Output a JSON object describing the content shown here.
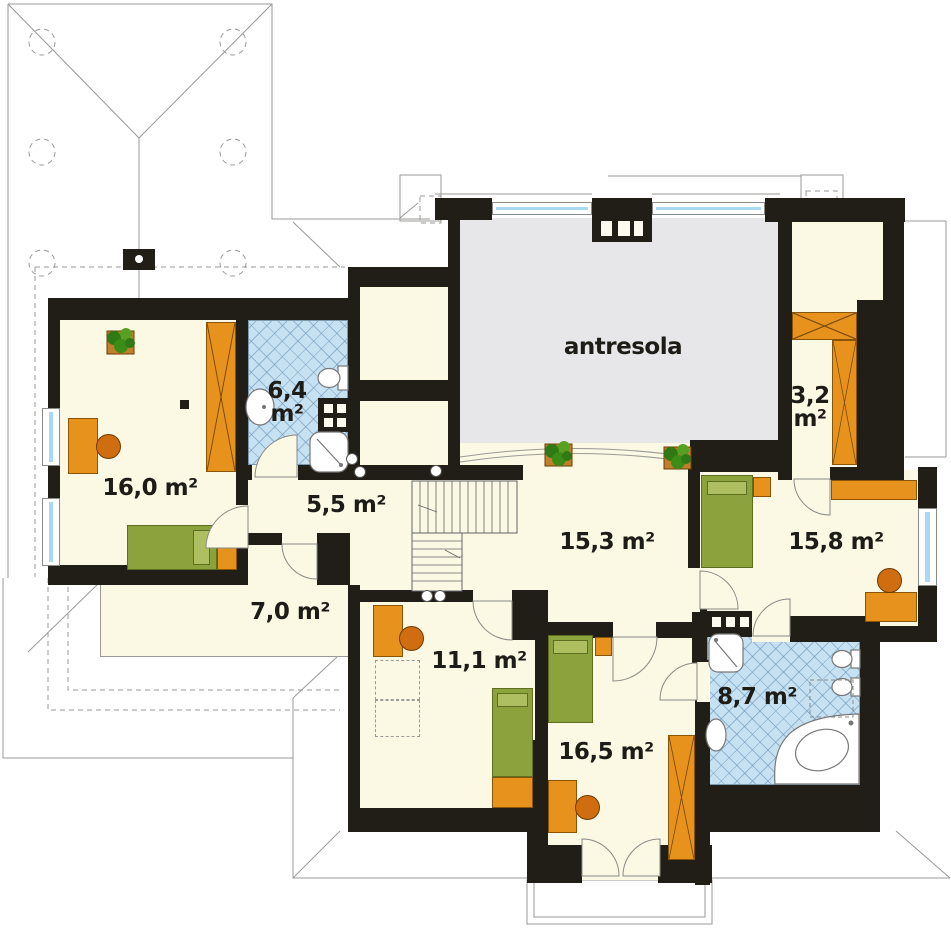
{
  "colors": {
    "wall": "#211e18",
    "floor": "#fbf8e4",
    "bath": "#c6e1f2",
    "mezz": "#e7e7e9",
    "orange": "#e8921e",
    "orangedark": "#cf6d10",
    "green": "#8ca23c",
    "window": "#a8d8f2",
    "line": "#9a9a96"
  },
  "mezzanine": {
    "label": "antresola"
  },
  "rooms": {
    "bedroom_left": "16,0 m²",
    "bath_upper_value": "6,4",
    "bath_upper_unit": "m²",
    "hall": "5,5 m²",
    "landing": "15,3 m²",
    "bedroom_right": "15,8 m²",
    "closet_value": "3,2",
    "closet_unit": "m²",
    "attic": "7,0 m²",
    "bedroom_bottom_left": "11,1 m²",
    "bedroom_bottom": "16,5 m²",
    "bath_lower": "8,7 m²"
  }
}
